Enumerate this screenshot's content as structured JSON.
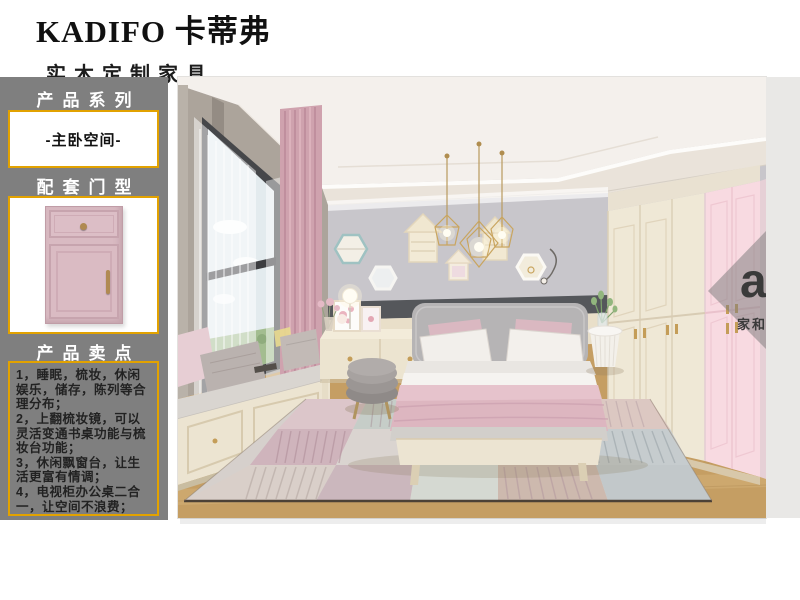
{
  "brand": {
    "title": "KADIFO 卡蒂弗",
    "subtitle": "实木定制家具"
  },
  "sidebar": {
    "section_product_series": "产品系列",
    "series_name": "-主卧空间-",
    "section_door_type": "配套门型",
    "section_selling_points": "产品卖点",
    "selling_points": [
      "1，睡眠，梳妆，休闲娱乐，储存，陈列等合理分布；",
      "2，上翻梳妆镜，可以灵活变通书桌功能与梳妆台功能；",
      "3，休闲飘窗台，让生活更富有情调；",
      "4，电视柜办公桌二合一，让空间不浪费；"
    ]
  },
  "watermark": {
    "logo": "a",
    "logo_sup": "3",
    "company": "家和设计"
  },
  "colors": {
    "accent_border": "#e2a200",
    "sidebar_bg": "#7f7f7f",
    "door_pink": "#d9bac2",
    "wardrobe_pink": "#f8dae1",
    "wardrobe_cream": "#efe8d6",
    "wall_lavender": "#c8c6cb"
  }
}
